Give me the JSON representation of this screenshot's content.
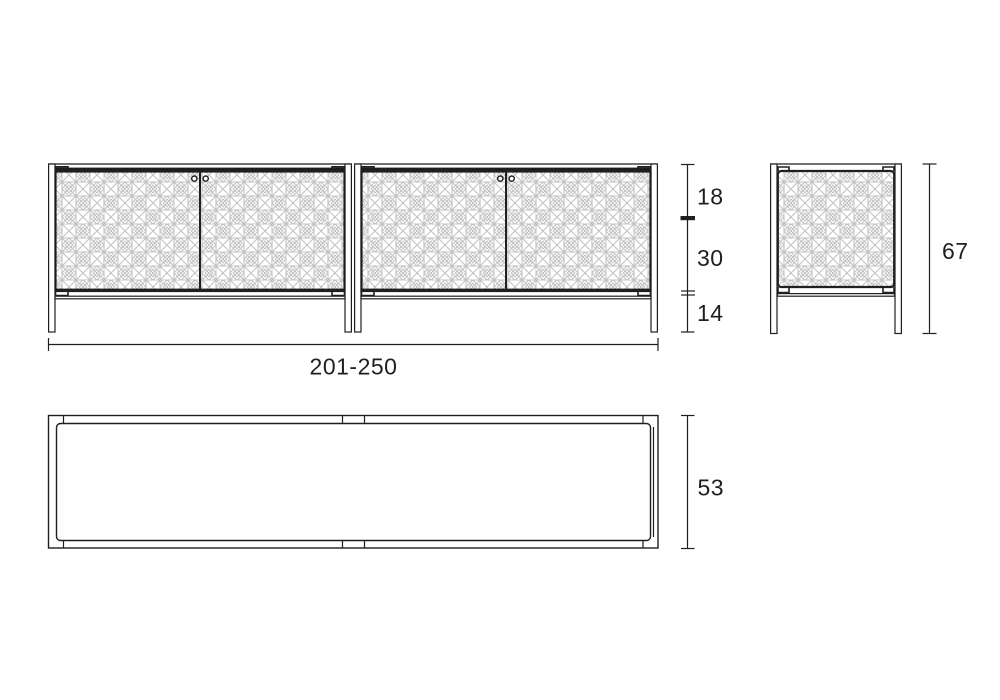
{
  "colors": {
    "line": "#1f1f1f",
    "pattern_line": "#c3c3c3",
    "background": "#ffffff"
  },
  "dimensions": {
    "front_width_label": "201-250",
    "front_top_section_label": "18",
    "front_middle_section_label": "30",
    "front_leg_section_label": "14",
    "side_total_height_label": "67",
    "top_view_depth_label": "53"
  }
}
